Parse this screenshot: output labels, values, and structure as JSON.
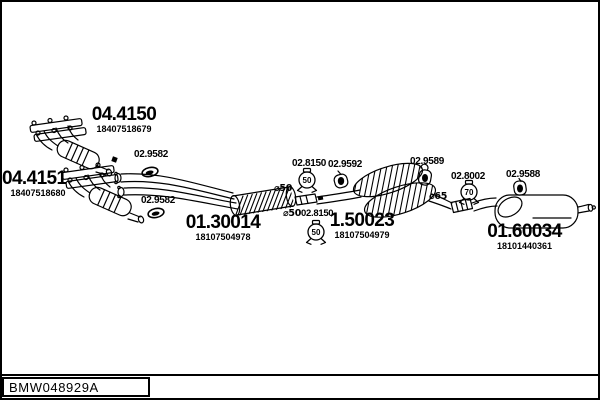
{
  "frame": {
    "drawing_code": "BMW048929A"
  },
  "parts": {
    "manifold_top": {
      "code": "04.4150",
      "number": "18407518679"
    },
    "manifold_bottom": {
      "code": "04.4151",
      "number": "18407518680"
    },
    "center_pipe": {
      "code": "01.30014",
      "number": "18107504978"
    },
    "mid_silencer": {
      "code": "1.50023",
      "number": "18107504979"
    },
    "rear_muffler": {
      "code": "01.60034",
      "number": "18101440361"
    }
  },
  "fittings": {
    "ring_front_upper": {
      "code": "02.9582",
      "type": "rubber-ring"
    },
    "ring_front_lower": {
      "code": "02.9582",
      "type": "rubber-ring"
    },
    "clamp_front": {
      "code": "02.8150",
      "size": "50",
      "type": "clamp"
    },
    "hanger_center": {
      "code": "02.9592",
      "type": "hanger"
    },
    "clamp_center": {
      "code": "02.8150",
      "size": "50",
      "type": "clamp"
    },
    "hanger_mid": {
      "code": "02.9589",
      "type": "hanger"
    },
    "clamp_rear": {
      "code": "02.8002",
      "size": "70",
      "type": "clamp"
    },
    "hanger_rear": {
      "code": "02.9588",
      "type": "hanger"
    }
  },
  "annotations": {
    "dia_front": "⌀50",
    "dia_center": "⌀50",
    "dia_rear": "⌀65"
  },
  "colors": {
    "line": "#000000",
    "background": "#ffffff"
  }
}
